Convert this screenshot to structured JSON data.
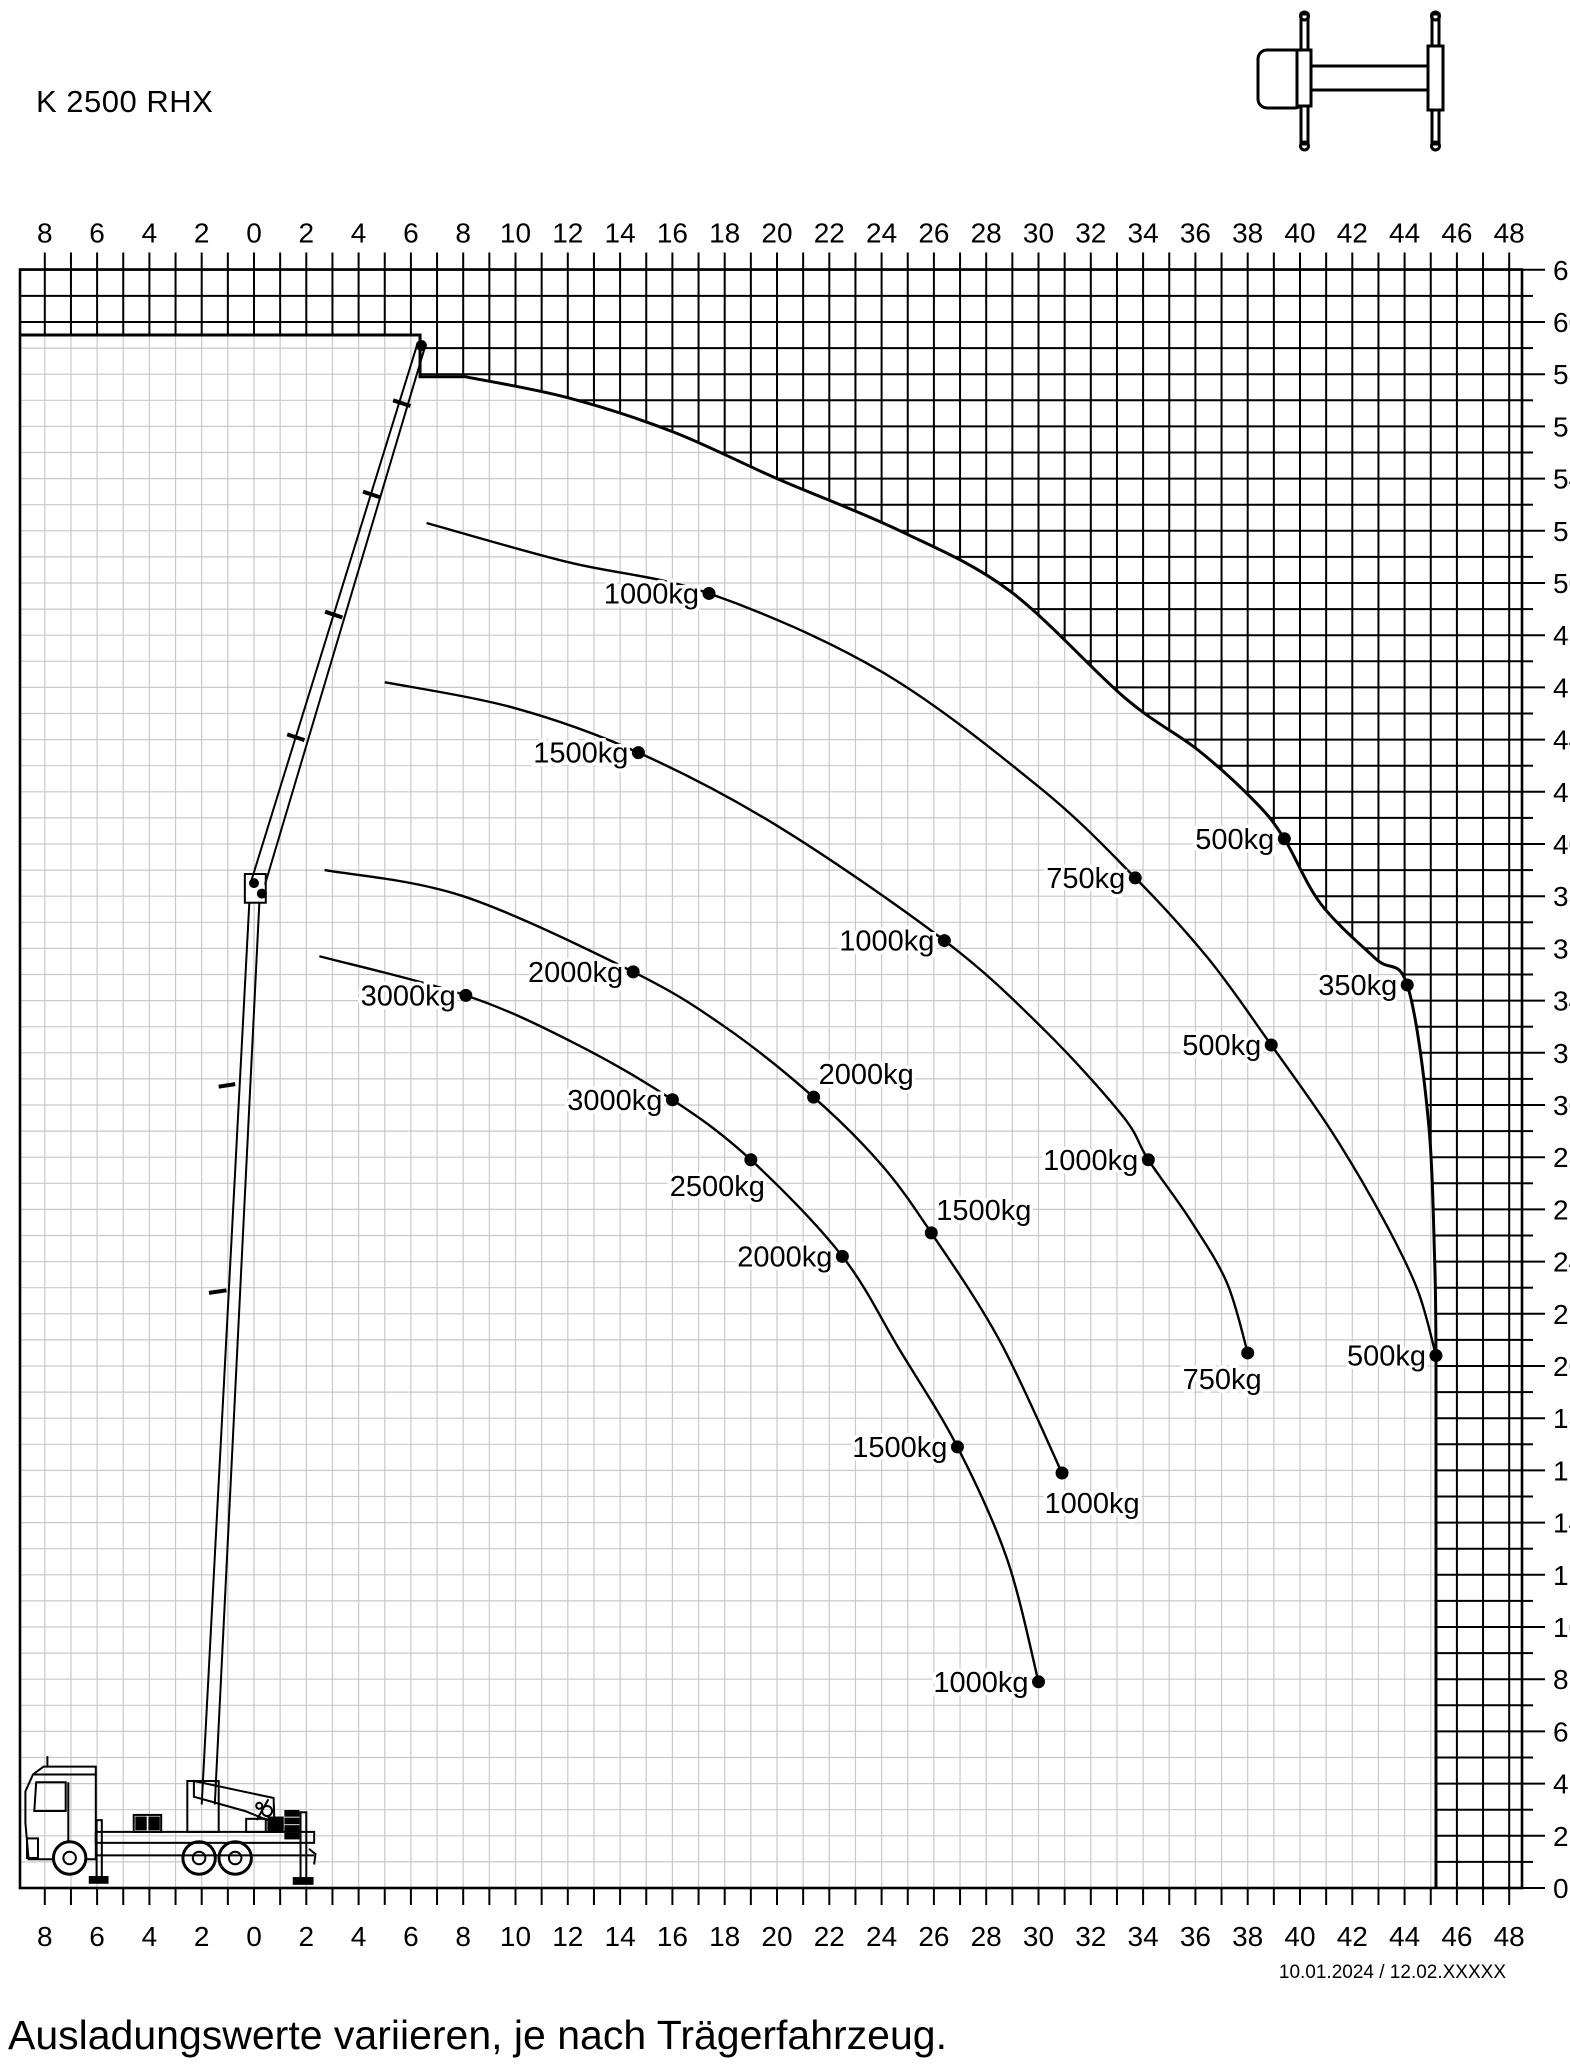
{
  "title": "K 2500 RHX",
  "footer_note": "Ausladungswerte variieren, je nach Trägerfahrzeug.",
  "revision": "10.01.2024 / 12.02.XXXXX",
  "colors": {
    "ink": "#000000",
    "light_grid": "#c9c9c9",
    "background": "#ffffff"
  },
  "icons": [
    {
      "name": "truck-top-view-outriggers-icon"
    },
    {
      "name": "truck-crane-side-view-illustration"
    }
  ],
  "chart_data": {
    "type": "line",
    "title": "K 2500 RHX",
    "xlabel": "",
    "ylabel": "",
    "x_range": [
      -8.95,
      48.55
    ],
    "ylim": [
      0,
      62
    ],
    "grid": {
      "step": 1,
      "label_step": 2,
      "inside_grid_color": "#c9c9c9",
      "outside_grid_color": "#000000"
    },
    "legend_position": "none",
    "x_ticks": [
      {
        "u": -8,
        "label": "8"
      },
      {
        "u": -6,
        "label": "6"
      },
      {
        "u": -4,
        "label": "4"
      },
      {
        "u": -2,
        "label": "2"
      },
      {
        "u": 0,
        "label": "0"
      },
      {
        "u": 2,
        "label": "2"
      },
      {
        "u": 4,
        "label": "4"
      },
      {
        "u": 6,
        "label": "6"
      },
      {
        "u": 8,
        "label": "8"
      },
      {
        "u": 10,
        "label": "10"
      },
      {
        "u": 12,
        "label": "12"
      },
      {
        "u": 14,
        "label": "14"
      },
      {
        "u": 16,
        "label": "16"
      },
      {
        "u": 18,
        "label": "18"
      },
      {
        "u": 20,
        "label": "20"
      },
      {
        "u": 22,
        "label": "22"
      },
      {
        "u": 24,
        "label": "24"
      },
      {
        "u": 26,
        "label": "26"
      },
      {
        "u": 28,
        "label": "28"
      },
      {
        "u": 30,
        "label": "30"
      },
      {
        "u": 32,
        "label": "32"
      },
      {
        "u": 34,
        "label": "34"
      },
      {
        "u": 36,
        "label": "36"
      },
      {
        "u": 38,
        "label": "38"
      },
      {
        "u": 40,
        "label": "40"
      },
      {
        "u": 42,
        "label": "42"
      },
      {
        "u": 44,
        "label": "44"
      },
      {
        "u": 46,
        "label": "46"
      },
      {
        "u": 48,
        "label": "48"
      }
    ],
    "y_ticks": [
      {
        "v": 0,
        "label": "0"
      },
      {
        "v": 2,
        "label": "2"
      },
      {
        "v": 4,
        "label": "4"
      },
      {
        "v": 6,
        "label": "6"
      },
      {
        "v": 8,
        "label": "8"
      },
      {
        "v": 10,
        "label": "10"
      },
      {
        "v": 12,
        "label": "12"
      },
      {
        "v": 14,
        "label": "14"
      },
      {
        "v": 16,
        "label": "16"
      },
      {
        "v": 18,
        "label": "18"
      },
      {
        "v": 20,
        "label": "20"
      },
      {
        "v": 22,
        "label": "22"
      },
      {
        "v": 24,
        "label": "24"
      },
      {
        "v": 26,
        "label": "26"
      },
      {
        "v": 28,
        "label": "28"
      },
      {
        "v": 30,
        "label": "30"
      },
      {
        "v": 32,
        "label": "32"
      },
      {
        "v": 34,
        "label": "34"
      },
      {
        "v": 36,
        "label": "36"
      },
      {
        "v": 38,
        "label": "38"
      },
      {
        "v": 40,
        "label": "40"
      },
      {
        "v": 42,
        "label": "42"
      },
      {
        "v": 44,
        "label": "44"
      },
      {
        "v": 46,
        "label": "46"
      },
      {
        "v": 48,
        "label": "48"
      },
      {
        "v": 50,
        "label": "50"
      },
      {
        "v": 52,
        "label": "52"
      },
      {
        "v": 54,
        "label": "54"
      },
      {
        "v": 56,
        "label": "56"
      },
      {
        "v": 58,
        "label": "58"
      },
      {
        "v": 60,
        "label": "60"
      },
      {
        "v": 62,
        "label": "62"
      }
    ],
    "envelope": {
      "steps": [
        [
          -8.95,
          59.5
        ],
        [
          6.35,
          59.5
        ],
        [
          6.35,
          57.9
        ],
        [
          8.1,
          57.9
        ]
      ],
      "arc": [
        [
          8.1,
          57.9
        ],
        [
          12,
          57.1
        ],
        [
          16,
          55.8
        ],
        [
          20,
          54.0
        ],
        [
          24.7,
          52.0
        ],
        [
          28.9,
          49.7
        ],
        [
          33.3,
          45.6
        ],
        [
          36.1,
          43.6
        ],
        [
          38.3,
          41.6
        ],
        [
          39.4,
          40.2
        ],
        [
          40.8,
          37.7
        ],
        [
          42.9,
          35.6
        ],
        [
          44.1,
          34.6
        ],
        [
          44.9,
          29.5
        ],
        [
          45.15,
          24.0
        ],
        [
          45.2,
          20.4
        ]
      ],
      "drop_to": [
        45.2,
        0
      ]
    },
    "curves": [
      {
        "name": "capacity-arc-1",
        "points": [
          [
            6.6,
            52.3
          ],
          [
            12,
            50.8
          ],
          [
            17.4,
            49.6
          ],
          [
            24,
            46.6
          ],
          [
            30,
            42.2
          ],
          [
            33.7,
            38.7
          ],
          [
            36.5,
            35.6
          ],
          [
            38.9,
            32.3
          ],
          [
            41.2,
            29.0
          ],
          [
            43.2,
            25.6
          ],
          [
            44.5,
            22.9
          ],
          [
            45.2,
            20.4
          ]
        ]
      },
      {
        "name": "capacity-arc-2",
        "points": [
          [
            5.0,
            46.2
          ],
          [
            10,
            45.2
          ],
          [
            14.7,
            43.5
          ],
          [
            20,
            40.7
          ],
          [
            26.4,
            36.3
          ],
          [
            30.2,
            32.9
          ],
          [
            33.2,
            29.6
          ],
          [
            34.2,
            27.9
          ],
          [
            35.8,
            25.6
          ],
          [
            37.2,
            23.2
          ],
          [
            38.0,
            20.5
          ]
        ]
      },
      {
        "name": "capacity-arc-3",
        "points": [
          [
            2.7,
            39.0
          ],
          [
            8,
            38.0
          ],
          [
            14.5,
            35.1
          ],
          [
            18,
            33.0
          ],
          [
            21.4,
            30.3
          ],
          [
            24,
            27.7
          ],
          [
            25.9,
            25.1
          ],
          [
            28.5,
            21.0
          ],
          [
            30.9,
            15.9
          ]
        ]
      },
      {
        "name": "capacity-arc-4",
        "points": [
          [
            2.5,
            35.7
          ],
          [
            8.1,
            34.2
          ],
          [
            12.2,
            32.4
          ],
          [
            16.0,
            30.2
          ],
          [
            19.0,
            27.9
          ],
          [
            22.5,
            24.2
          ],
          [
            24.7,
            20.6
          ],
          [
            26.9,
            16.9
          ],
          [
            28.8,
            12.6
          ],
          [
            30.0,
            7.9
          ]
        ]
      }
    ],
    "point_labels": [
      {
        "text": "1000kg",
        "x": 17.4,
        "y": 49.6,
        "side": "left"
      },
      {
        "text": "1500kg",
        "x": 14.7,
        "y": 43.5,
        "side": "left"
      },
      {
        "text": "500kg",
        "x": 39.4,
        "y": 40.2,
        "side": "left"
      },
      {
        "text": "750kg",
        "x": 33.7,
        "y": 38.7,
        "side": "left"
      },
      {
        "text": "1000kg",
        "x": 26.4,
        "y": 36.3,
        "side": "left"
      },
      {
        "text": "2000kg",
        "x": 14.5,
        "y": 35.1,
        "side": "left"
      },
      {
        "text": "3000kg",
        "x": 8.1,
        "y": 34.2,
        "side": "left"
      },
      {
        "text": "350kg",
        "x": 44.1,
        "y": 34.6,
        "side": "left"
      },
      {
        "text": "500kg",
        "x": 38.9,
        "y": 32.3,
        "side": "left"
      },
      {
        "text": "2000kg",
        "x": 21.4,
        "y": 30.3,
        "side": "above-right"
      },
      {
        "text": "3000kg",
        "x": 16.0,
        "y": 30.2,
        "side": "left"
      },
      {
        "text": "2500kg",
        "x": 19.0,
        "y": 27.9,
        "side": "below-left"
      },
      {
        "text": "1000kg",
        "x": 34.2,
        "y": 27.9,
        "side": "left"
      },
      {
        "text": "1500kg",
        "x": 25.9,
        "y": 25.1,
        "side": "above-right"
      },
      {
        "text": "2000kg",
        "x": 22.5,
        "y": 24.2,
        "side": "left"
      },
      {
        "text": "750kg",
        "x": 38.0,
        "y": 20.5,
        "side": "below-left"
      },
      {
        "text": "500kg",
        "x": 45.2,
        "y": 20.4,
        "side": "left"
      },
      {
        "text": "1500kg",
        "x": 26.9,
        "y": 16.9,
        "side": "left"
      },
      {
        "text": "1000kg",
        "x": 30.9,
        "y": 15.9,
        "side": "below"
      },
      {
        "text": "1000kg",
        "x": 30.0,
        "y": 7.9,
        "side": "left"
      }
    ]
  }
}
